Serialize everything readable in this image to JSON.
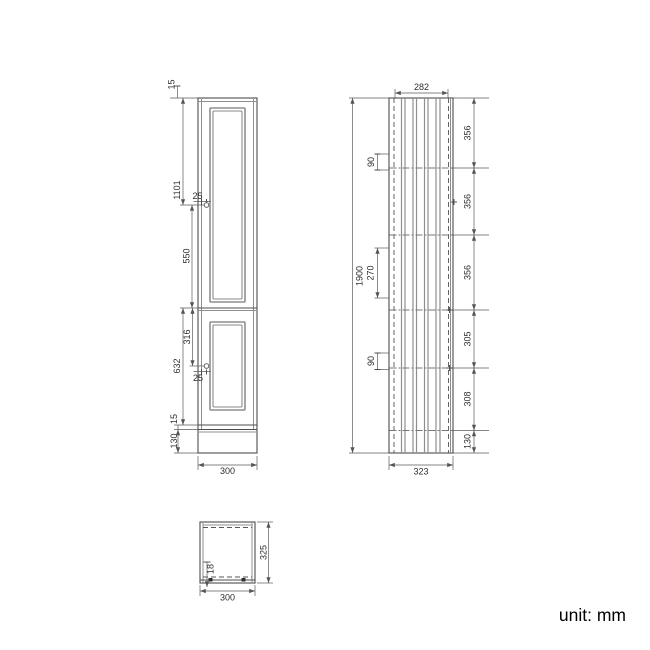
{
  "unit_label": "unit: mm",
  "front": {
    "dim_top_frame": "15",
    "dim_handle_top": "1101",
    "dim_handle_inset_top": "25",
    "dim_upper_panel": "550",
    "dim_lower_handle": "316",
    "dim_lower_door": "632",
    "dim_handle_inset_bottom": "25",
    "dim_bottom_gap": "15",
    "dim_plinth": "130",
    "dim_width": "300"
  },
  "side": {
    "dim_depth_top": "282",
    "dim_height": "1900",
    "dim_hinge_top": "90",
    "dim_mid_bracket": "270",
    "dim_hinge_bottom": "90",
    "sections": [
      "356",
      "356",
      "356",
      "305",
      "308",
      "130"
    ],
    "dim_depth_bottom": "323"
  },
  "top": {
    "dim_thickness": "18",
    "dim_depth": "325",
    "dim_width": "300"
  }
}
